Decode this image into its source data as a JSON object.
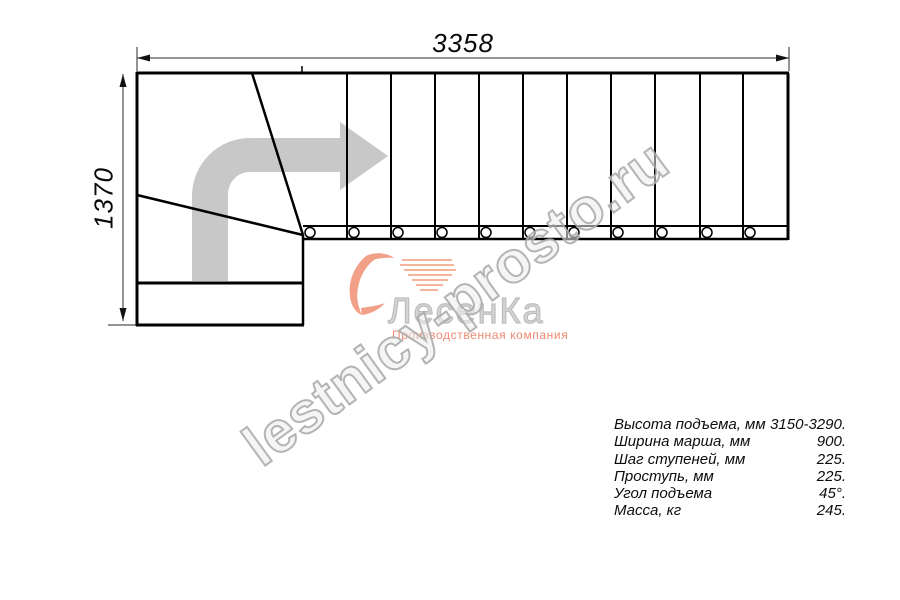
{
  "dimensions": {
    "width_label": "3358",
    "height_label": "1370"
  },
  "watermark": {
    "text": "lestnicy-prosto.ru"
  },
  "logo": {
    "name": "ЛесенКа",
    "tagline": "Производственная компания"
  },
  "specs": {
    "rows": [
      {
        "label": "Высота подъема, мм",
        "value": "3150-3290."
      },
      {
        "label": "Ширина марша, мм",
        "value": "900."
      },
      {
        "label": "Шаг ступеней, мм",
        "value": "225."
      },
      {
        "label": "Проступь, мм",
        "value": "225."
      },
      {
        "label": "Угол подъема",
        "value": "45°."
      },
      {
        "label": "Масса, кг",
        "value": "245."
      }
    ]
  },
  "colors": {
    "line_black": "#000000",
    "arrow_gray": "#c8c8c8",
    "logo_salmon": "#f2a087",
    "logo_speed": "#f6b49c",
    "watermark_gray": "#a8a8a8"
  }
}
